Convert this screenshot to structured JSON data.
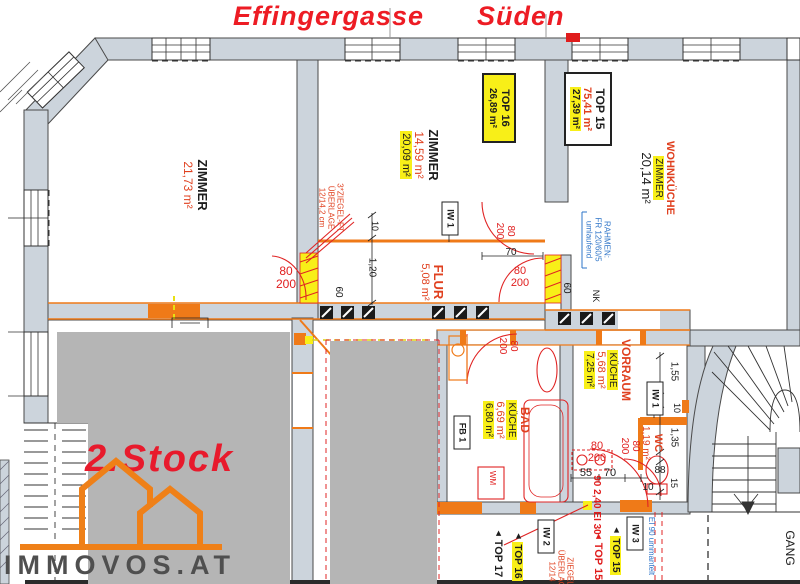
{
  "title": {
    "street": "Effingergasse",
    "direction": "Süden"
  },
  "branding": {
    "floor_label": "2.Stock",
    "brand": "IMMOVOS.AT"
  },
  "rooms": {
    "zimmer_left": {
      "name": "ZIMMER",
      "area": "21,73 m²"
    },
    "zimmer_mid": {
      "name": "ZIMMER",
      "area_old": "14,59 m²",
      "area_new": "20,09 m²"
    },
    "flur": {
      "name": "FLUR",
      "area": "5,08 m²"
    },
    "wohnkueche": {
      "name": "WOHNKÜCHE",
      "name_new": "ZIMMER",
      "area": "20,14 m²"
    },
    "bad": {
      "name": "BAD",
      "name_new": "KÜCHE",
      "area_old": "6,69 m²",
      "area_new": "6,80 m²"
    },
    "vorraum": {
      "name": "VORRAUM",
      "name_new": "KÜCHE",
      "area_old": "5,68 m²",
      "area_new": "7,25 m²"
    },
    "wc": {
      "name": "WC",
      "area": "1,19 m²"
    },
    "gang": {
      "name": "GANG"
    }
  },
  "unit_boxes": {
    "top16": {
      "label": "TOP 16",
      "area": "26,89 m²"
    },
    "top15": {
      "label": "TOP 15",
      "area_old": "75,41 m²",
      "area_new": "27,39 m²"
    }
  },
  "entrance_markers": {
    "top17": {
      "icon": "◄",
      "label": "TOP 17"
    },
    "top16": {
      "icon": "◄",
      "label": "TOP 16"
    },
    "top15_old": {
      "icon": "◄",
      "label": "TOP 15"
    },
    "top15_new": {
      "icon": "◄",
      "label": "TOP 15"
    }
  },
  "wall_tags": {
    "iw1_a": "IW 1",
    "iw1_b": "IW 1",
    "iw2": "IW 2",
    "iw3": "IW 3",
    "fb1": "FB 1",
    "wm": "WM",
    "nk": "NK"
  },
  "notes": {
    "lintel": [
      "3*ZIEGEL-FT",
      "ÜBERLAGE",
      "12/14,2 cm"
    ],
    "frame": [
      "RAHMEN:",
      "FR 120/60/5",
      "umlaufend"
    ],
    "fire_jacket": "EI 90 ummantelt",
    "fire_door": "90 2,40 EI 30",
    "lintel2": [
      "ZIEGEL",
      "ÜBERLAGE",
      "12/14"
    ]
  },
  "door_size": {
    "width": "80",
    "height": "200"
  },
  "dims": {
    "t10": "10",
    "t120": "1,20",
    "t60": "60",
    "t70": "70",
    "t60b": "60",
    "v155": "1,55",
    "v10": "10",
    "v135": "1,35",
    "v88": "88",
    "v15": "15",
    "b55": "55",
    "b70": "70",
    "b10": "10"
  },
  "colors": {
    "wall": "#ccd4dc",
    "mask": "#b5b5b5",
    "new_work": "#ef7a18",
    "markup_red": "#e02424",
    "highlight": "#f8ef18",
    "note_blue": "#2e74c8",
    "title_red": "#ed1c24"
  }
}
